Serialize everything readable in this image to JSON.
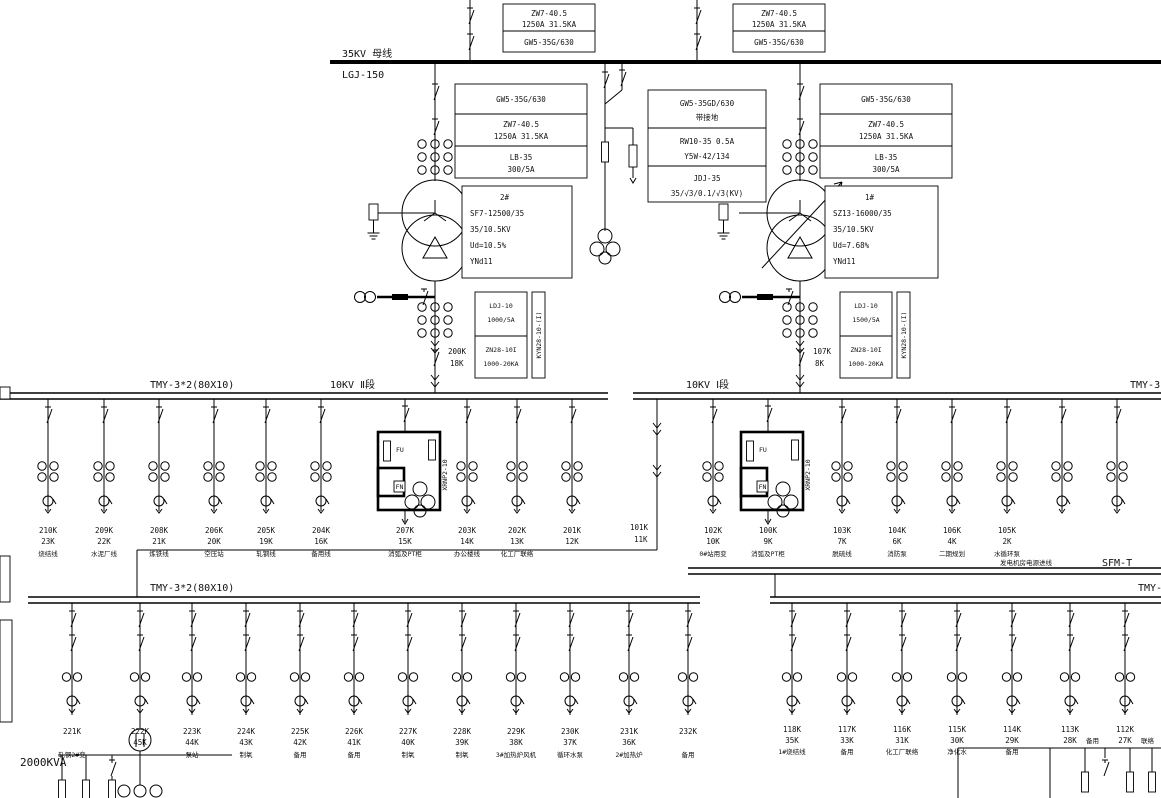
{
  "bus35": {
    "label": "35KV 母线",
    "conductor": "LGJ-150"
  },
  "top_box": {
    "l1": "ZW7-40.5",
    "l2": "1250A 31.5KA",
    "l3": "GW5-35G/630"
  },
  "bay35": {
    "b1": "GW5-35G/630",
    "b2a": "ZW7-40.5",
    "b2b": "1250A 31.5KA",
    "b3a": "LB-35",
    "b3b": "300/5A"
  },
  "pt35": {
    "b1a": "GW5-35GD/630",
    "b1b": "带接地",
    "b2a": "RW10-35 0.5A",
    "b2b": "Y5W-42/134",
    "b3a": "JDJ-35",
    "b3b": "35/√3/0.1/√3(KV)"
  },
  "tx_left": {
    "id": "2#",
    "model": "SF7-12500/35",
    "ratio": "35/10.5KV",
    "uk": "Ud=10.5%",
    "vector": "YNd11"
  },
  "tx_right": {
    "id": "1#",
    "model": "SZ13-16000/35",
    "ratio": "35/10.5KV",
    "uk": "Ud=7.68%",
    "vector": "YNd11"
  },
  "incomer_left": {
    "ct": "LDJ-10",
    "ratio": "1000/5A",
    "breaker": "ZN28-10I",
    "capacity": "1000-20KA",
    "cabinet": "KYN28-10-(I)",
    "code": "200K",
    "num": "18K"
  },
  "incomer_right": {
    "ct": "LDJ-10",
    "ratio": "1500/5A",
    "breaker": "ZN28-10I",
    "capacity": "1000-20KA",
    "cabinet": "KYN28-10-(I)",
    "code": "107K",
    "num": "8K"
  },
  "bus10_left": {
    "busbar": "TMY-3*2(80X10)",
    "label": "10KV Ⅱ段"
  },
  "bus10_right": {
    "label": "10KV Ⅰ段",
    "busbar": "TMY-3"
  },
  "lower_left": {
    "busbar": "TMY-3*2(80X10)",
    "kva": "2000KVA"
  },
  "lower_right": {
    "busbar": "TMY-",
    "note": "发电机房电源进线",
    "code": "SFM-T"
  },
  "pt_bay_left": {
    "code": "207K",
    "num": "15K",
    "name": "消弧及PT柜",
    "fu": "FU",
    "fn": "FN",
    "fuse": "XRNP2-10"
  },
  "pt_bay_right": {
    "code": "100K",
    "num": "9K",
    "name": "消弧及PT柜",
    "fu": "FU",
    "fn": "FN",
    "fuse": "XRNP2-10"
  },
  "tie": {
    "code": "101K",
    "num": "11K"
  },
  "feeders": {
    "mid_left": [
      {
        "id": "210K",
        "amp": "23K",
        "name": "烧结线"
      },
      {
        "id": "209K",
        "amp": "22K",
        "name": "水泥厂线"
      },
      {
        "id": "208K",
        "amp": "21K",
        "name": "炼铁线"
      },
      {
        "id": "206K",
        "amp": "20K",
        "name": "空压站"
      },
      {
        "id": "205K",
        "amp": "19K",
        "name": "轧钢线"
      },
      {
        "id": "204K",
        "amp": "16K",
        "name": "备用线"
      },
      {
        "id": "203K",
        "amp": "14K",
        "name": "办公楼线"
      },
      {
        "id": "202K",
        "amp": "13K",
        "name": "化工厂联络"
      },
      {
        "id": "201K",
        "amp": "12K",
        "name": ""
      }
    ],
    "mid_right": [
      {
        "id": "102K",
        "amp": "10K",
        "name": "0#站用变"
      },
      {
        "id": "103K",
        "amp": "7K",
        "name": "脱硫线"
      },
      {
        "id": "104K",
        "amp": "6K",
        "name": "消防泵"
      },
      {
        "id": "106K",
        "amp": "4K",
        "name": "二期规划"
      },
      {
        "id": "105K",
        "amp": "2K",
        "name": "水循环泵"
      }
    ],
    "bottom_left": [
      {
        "id": "221K",
        "amp": "",
        "name": "轧钢2#变"
      },
      {
        "id": "222K",
        "amp": "45K",
        "name": ""
      },
      {
        "id": "223K",
        "amp": "44K",
        "name": "泵站"
      },
      {
        "id": "224K",
        "amp": "43K",
        "name": "制氧"
      },
      {
        "id": "225K",
        "amp": "42K",
        "name": "备用"
      },
      {
        "id": "226K",
        "amp": "41K",
        "name": "备用"
      },
      {
        "id": "227K",
        "amp": "40K",
        "name": "制氧"
      },
      {
        "id": "228K",
        "amp": "39K",
        "name": "制氧"
      },
      {
        "id": "229K",
        "amp": "38K",
        "name": "3#加热炉风机"
      },
      {
        "id": "230K",
        "amp": "37K",
        "name": "循环水泵"
      },
      {
        "id": "231K",
        "amp": "36K",
        "name": "2#加热炉"
      },
      {
        "id": "232K",
        "amp": "",
        "name": "备用"
      }
    ],
    "bottom_right": [
      {
        "id": "118K",
        "amp": "35K",
        "name": "1#烧结线"
      },
      {
        "id": "117K",
        "amp": "33K",
        "name": "备用"
      },
      {
        "id": "116K",
        "amp": "31K",
        "name": "化工厂联络"
      },
      {
        "id": "115K",
        "amp": "30K",
        "name": "净化水"
      },
      {
        "id": "114K",
        "amp": "29K",
        "name": "备用"
      },
      {
        "id": "113K",
        "amp": "28K",
        "name": "备用"
      },
      {
        "id": "112K",
        "amp": "27K",
        "name": "联络"
      }
    ]
  }
}
